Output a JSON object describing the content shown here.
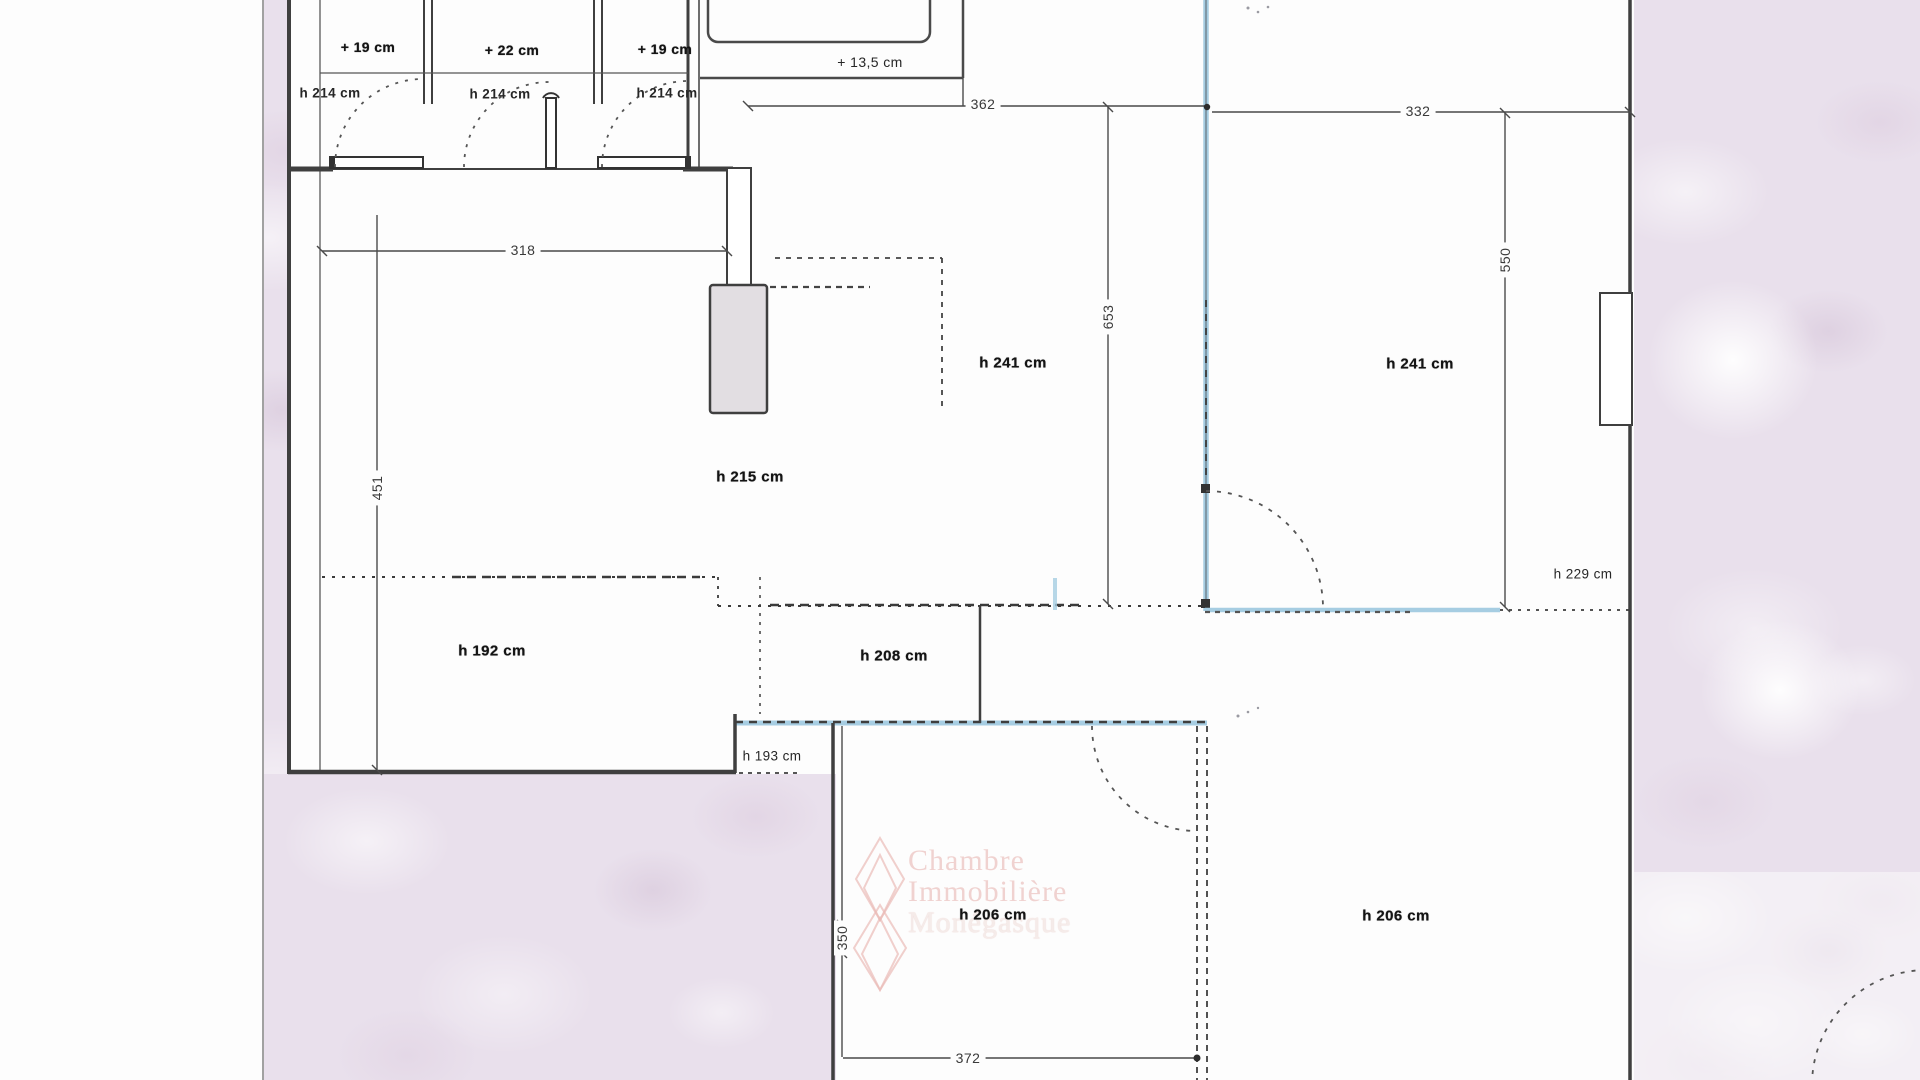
{
  "document": {
    "kind": "scanned apartment floor plan",
    "units": "cm"
  },
  "colors": {
    "wall": "#3f3f3f",
    "dimension_line": "#4a4a4a",
    "highlight_blue": "#a6cde2",
    "scan_pink": "#e9e0ec",
    "pillar_fill": "#e2dee2",
    "watermark_pink": "#e8b8b4"
  },
  "closets": {
    "c1": {
      "level": "+ 19 cm",
      "height": "h 214 cm"
    },
    "c2": {
      "level": "+ 22 cm",
      "height": "h 214 cm"
    },
    "c3": {
      "level": "+ 19 cm",
      "height": "h 214 cm"
    }
  },
  "balcony": {
    "level": "+ 13,5 cm"
  },
  "dimensions": {
    "d362": "362",
    "d332": "332",
    "d318": "318",
    "d451": "451",
    "d653": "653",
    "d550": "550",
    "d350": "350",
    "d372": "372"
  },
  "ceiling_heights": {
    "h241a": "h 241 cm",
    "h241b": "h 241 cm",
    "h215": "h 215 cm",
    "h229": "h 229 cm",
    "h192": "h 192 cm",
    "h208": "h 208 cm",
    "h193": "h 193 cm",
    "h206a": "h 206 cm",
    "h206b": "h 206 cm"
  },
  "watermark": {
    "line1": "Chambre",
    "line2": "Immobilière",
    "line3": "Monégasque"
  }
}
